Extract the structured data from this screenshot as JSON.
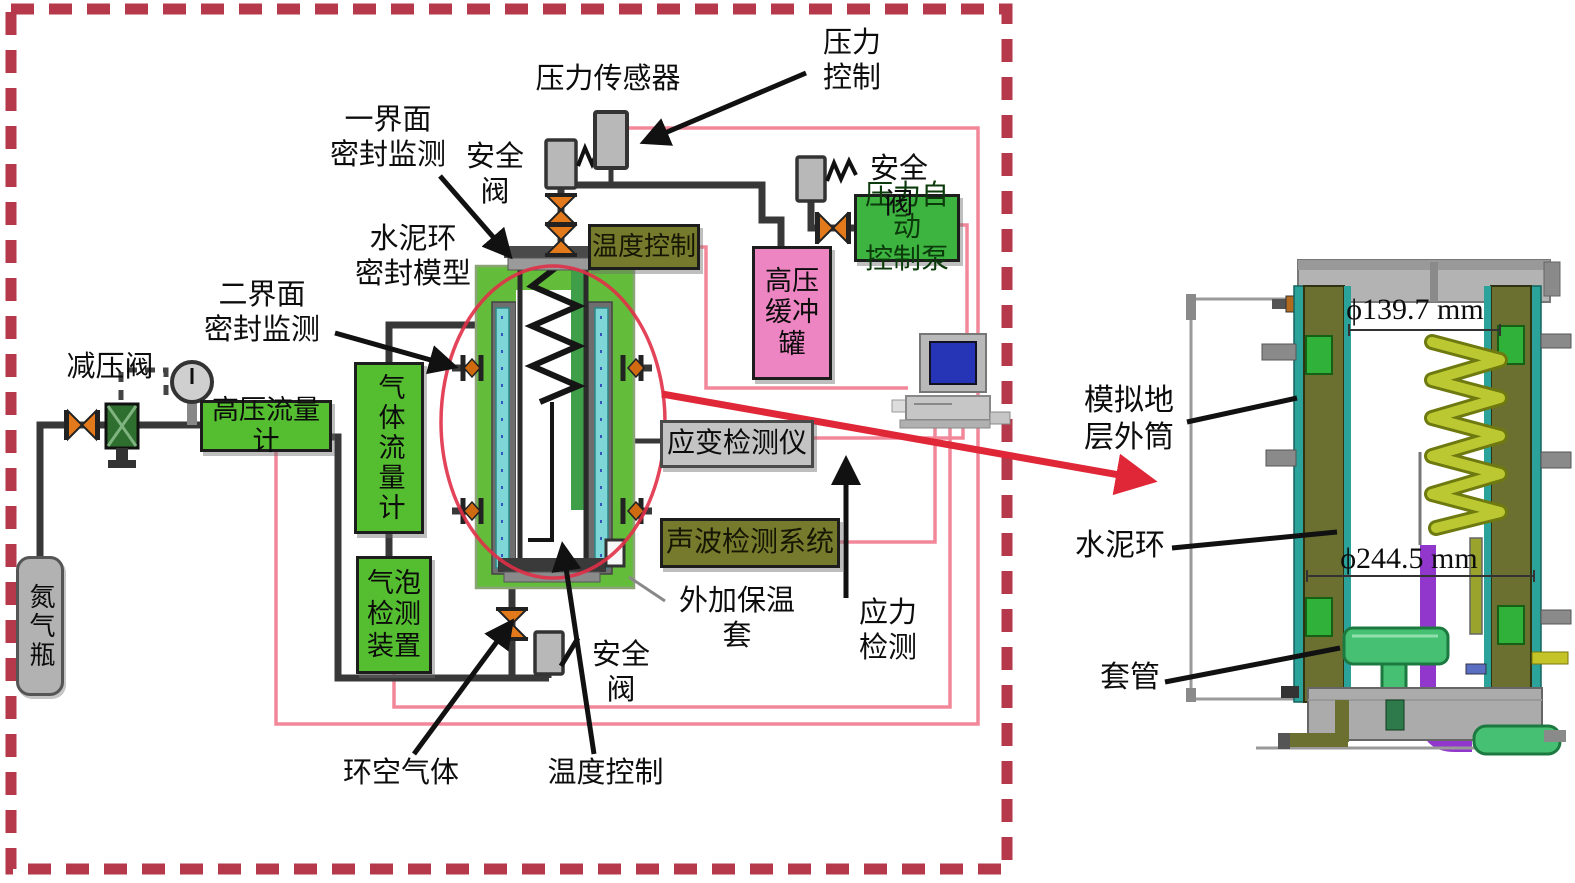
{
  "colors": {
    "dashed_border": "#b5394a",
    "pipe_black": "#383838",
    "signal_wire_pink": "#f2879a",
    "highlight_red": "#df2738",
    "green_box": "#55bd30",
    "pump_green": "#3eb440",
    "olive_box": "#767a2c",
    "buffer_pink": "#ee85c3",
    "instrument_gray": "#c3c3c3",
    "valve_orange": "#e2791b",
    "vessel_green": "#64bd3a",
    "liner_cyan": "#7fd6d6",
    "model_wall_olive": "#6b7030",
    "model_edge_teal": "#2ba39b",
    "coil_yellow_green": "#bcc832",
    "casing_green": "#46c072",
    "pipe_purple": "#9137cc"
  },
  "labels": {
    "pressure_sensor": "压力传感器",
    "pressure_control": "压力\n控制",
    "safety_valve": "安全阀",
    "interface1_monitor": "一界面\n密封监测",
    "cement_seal_model": "水泥环\n密封模型",
    "interface2_monitor": "二界面\n密封监测",
    "reducer_valve": "减压阀",
    "external_insulation": "外加保温套",
    "stress_detection": "应力\n检测",
    "annular_gas": "环空气体",
    "temp_control_bottom": "温度控制"
  },
  "boxes": {
    "hp_flowmeter": "高压流量计",
    "gas_flowmeter": "气体流量计",
    "bubble_detector": "气泡检测装置",
    "temp_control": "温度控制",
    "hp_buffer_tank": "高压缓冲罐",
    "auto_pressure_pump": "压力自动\n控制泵",
    "strain_detector": "应变检测仪",
    "acoustic_detector": "声波检测系统",
    "nitrogen_bottle": "氮气瓶"
  },
  "model": {
    "outer_cylinder": "模拟地\n层外筒",
    "cement_ring": "水泥环",
    "casing": "套管",
    "dia_top": "ϕ139.7 mm",
    "dia_mid": "ϕ244.5 mm"
  },
  "icons": {
    "butterfly_valve": "bowtie-triangles",
    "safety_valve": "gray-block-with-spring",
    "pressure_gauge": "dial-circle",
    "computer": "desktop-pc"
  }
}
